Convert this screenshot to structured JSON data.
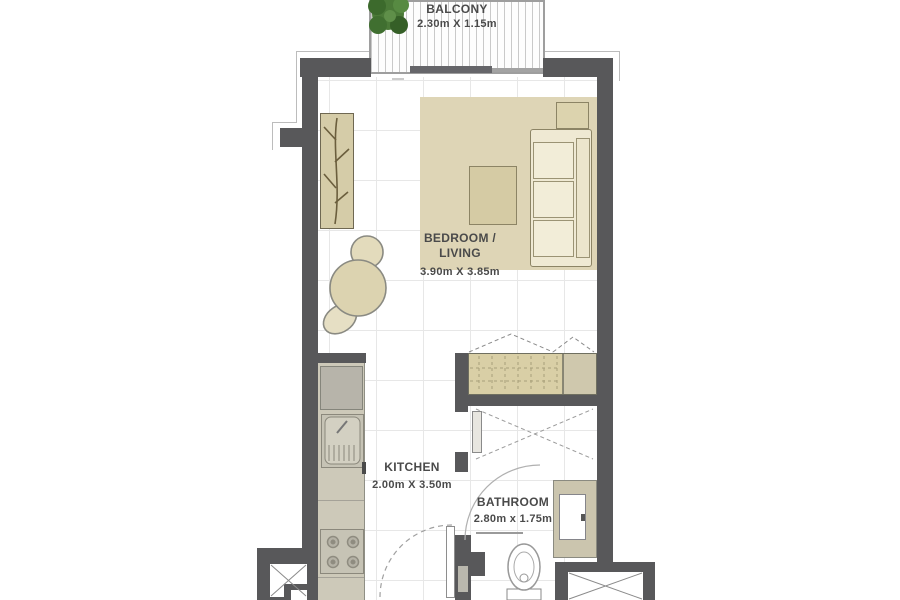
{
  "plan": {
    "type": "studio-apartment-floor-plan",
    "rooms": {
      "balcony": {
        "label": "BALCONY",
        "dimensions": "2.30m X 1.15m"
      },
      "bedroom_living": {
        "label_line1": "BEDROOM /",
        "label_line2": "LIVING",
        "dimensions": "3.90m X 3.85m"
      },
      "kitchen": {
        "label": "KITCHEN",
        "dimensions": "2.00m X 3.50m"
      },
      "bathroom": {
        "label": "BATHROOM",
        "dimensions": "2.80m x 1.75m"
      }
    },
    "colors": {
      "wall": "#58585a",
      "furniture_beige": "#ddd4b4",
      "rug": "#ded5b6",
      "sofa_cream": "#efe9d3",
      "counter": "#cdc9b9",
      "closet": "#d9cfa6",
      "shower": "#cbc5ae",
      "plant_green": "#4b7a38",
      "text": "#4a4a4a"
    },
    "fixtures": [
      "balcony-plant",
      "sliding-door",
      "rug",
      "sofa",
      "side-table",
      "coffee-table",
      "wardrobe",
      "armchair",
      "built-in-closet",
      "kitchen-counter",
      "fridge",
      "sink",
      "stove",
      "entrance-door",
      "interior-door",
      "toilet",
      "shower",
      "service-shaft-left",
      "service-shaft-right"
    ]
  }
}
